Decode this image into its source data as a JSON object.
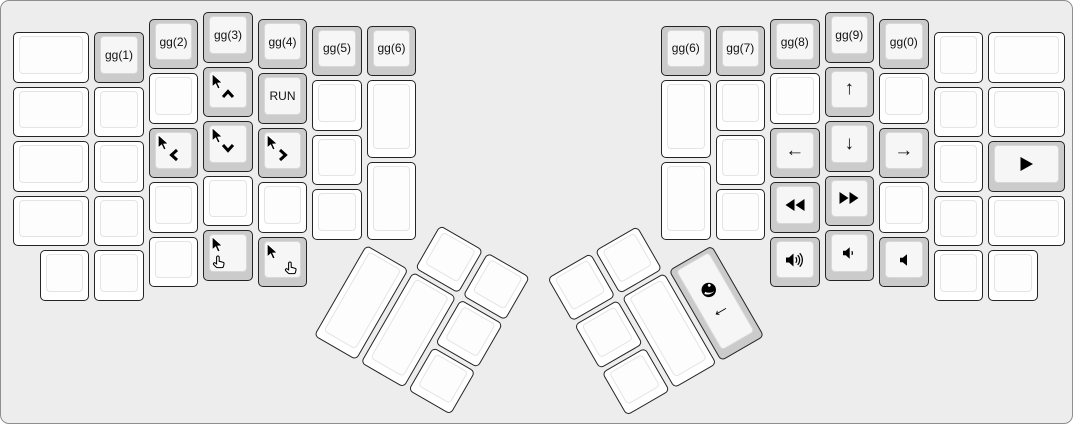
{
  "colors": {
    "canvas_bg": "#ededed",
    "key_white": "#ffffff",
    "key_gray": "#cccccc",
    "legend": "#111111",
    "key_border": "#242424"
  },
  "groups": [
    {
      "name": "left-main",
      "keys": [
        {
          "name": "key-blank",
          "x": 0,
          "y": 0.375,
          "w": 1.5,
          "color": "white"
        },
        {
          "name": "key-gg-1",
          "x": 1.5,
          "y": 0.375,
          "color": "gray",
          "label": "gg(1)"
        },
        {
          "name": "key-gg-2",
          "x": 2.5,
          "y": 0.125,
          "color": "gray",
          "label": "gg(2)"
        },
        {
          "name": "key-gg-3",
          "x": 3.5,
          "y": 0,
          "color": "gray",
          "label": "gg(3)"
        },
        {
          "name": "key-gg-4",
          "x": 4.5,
          "y": 0.125,
          "color": "gray",
          "label": "gg(4)"
        },
        {
          "name": "key-gg-5",
          "x": 5.5,
          "y": 0.25,
          "color": "gray",
          "label": "gg(5)"
        },
        {
          "name": "key-gg-6-left",
          "x": 6.5,
          "y": 0.25,
          "color": "gray",
          "label": "gg(6)"
        },
        {
          "name": "key-blank",
          "x": 0,
          "y": 1.375,
          "w": 1.5,
          "color": "white"
        },
        {
          "name": "key-blank",
          "x": 1.5,
          "y": 1.375,
          "color": "white"
        },
        {
          "name": "key-blank",
          "x": 2.5,
          "y": 1.125,
          "color": "white"
        },
        {
          "name": "key-mouse-up",
          "x": 3.5,
          "y": 1,
          "color": "gray",
          "icons": [
            {
              "icon": "mouse-cursor",
              "pos": "tl"
            },
            {
              "icon": "chevron-up",
              "pos": "c"
            }
          ]
        },
        {
          "name": "key-run",
          "x": 4.5,
          "y": 1.125,
          "color": "gray",
          "label": "RUN"
        },
        {
          "name": "key-blank",
          "x": 5.5,
          "y": 1.25,
          "color": "white"
        },
        {
          "name": "key-blank",
          "x": 6.5,
          "y": 1.25,
          "h": 1.5,
          "color": "white"
        },
        {
          "name": "key-blank",
          "x": 0,
          "y": 2.375,
          "w": 1.5,
          "color": "white"
        },
        {
          "name": "key-blank",
          "x": 1.5,
          "y": 2.375,
          "color": "white"
        },
        {
          "name": "key-mouse-left",
          "x": 2.5,
          "y": 2.125,
          "color": "gray",
          "icons": [
            {
              "icon": "mouse-cursor",
              "pos": "tl"
            },
            {
              "icon": "chevron-left",
              "pos": "c"
            }
          ]
        },
        {
          "name": "key-mouse-down",
          "x": 3.5,
          "y": 2,
          "color": "gray",
          "icons": [
            {
              "icon": "mouse-cursor",
              "pos": "tl"
            },
            {
              "icon": "chevron-down",
              "pos": "c"
            }
          ]
        },
        {
          "name": "key-mouse-right",
          "x": 4.5,
          "y": 2.125,
          "color": "gray",
          "icons": [
            {
              "icon": "mouse-cursor",
              "pos": "tl"
            },
            {
              "icon": "chevron-right",
              "pos": "c"
            }
          ]
        },
        {
          "name": "key-blank",
          "x": 5.5,
          "y": 2.25,
          "color": "white"
        },
        {
          "name": "key-blank",
          "x": 6.5,
          "y": 2.75,
          "h": 1.5,
          "color": "white"
        },
        {
          "name": "key-blank",
          "x": 0,
          "y": 3.375,
          "w": 1.5,
          "color": "white"
        },
        {
          "name": "key-blank",
          "x": 1.5,
          "y": 3.375,
          "color": "white"
        },
        {
          "name": "key-blank",
          "x": 2.5,
          "y": 3.125,
          "color": "white"
        },
        {
          "name": "key-blank",
          "x": 3.5,
          "y": 3,
          "color": "white"
        },
        {
          "name": "key-blank",
          "x": 4.5,
          "y": 3.125,
          "color": "white"
        },
        {
          "name": "key-blank",
          "x": 5.5,
          "y": 3.25,
          "color": "white"
        },
        {
          "name": "key-blank",
          "x": 0.5,
          "y": 4.375,
          "color": "white"
        },
        {
          "name": "key-blank",
          "x": 1.5,
          "y": 4.375,
          "color": "white"
        },
        {
          "name": "key-blank",
          "x": 2.5,
          "y": 4.125,
          "color": "white"
        },
        {
          "name": "key-mouse-button-1",
          "x": 3.5,
          "y": 4,
          "color": "gray",
          "icons": [
            {
              "icon": "mouse-cursor",
              "pos": "tl"
            },
            {
              "icon": "pointing-hand",
              "pos": "bl"
            }
          ]
        },
        {
          "name": "key-mouse-button-2",
          "x": 4.5,
          "y": 4.125,
          "color": "gray",
          "icons": [
            {
              "icon": "mouse-cursor",
              "pos": "tl"
            },
            {
              "icon": "pointing-hand",
              "pos": "br"
            }
          ]
        }
      ]
    },
    {
      "name": "right-main",
      "keys": [
        {
          "name": "key-gg-6-right",
          "x": 11.9,
          "y": 0.25,
          "color": "gray",
          "label": "gg(6)"
        },
        {
          "name": "key-gg-7",
          "x": 12.9,
          "y": 0.25,
          "color": "gray",
          "label": "gg(7)"
        },
        {
          "name": "key-gg-8",
          "x": 13.9,
          "y": 0.125,
          "color": "gray",
          "label": "gg(8)"
        },
        {
          "name": "key-gg-9",
          "x": 14.9,
          "y": 0,
          "color": "gray",
          "label": "gg(9)"
        },
        {
          "name": "key-gg-0",
          "x": 15.9,
          "y": 0.125,
          "color": "gray",
          "label": "gg(0)"
        },
        {
          "name": "key-blank",
          "x": 16.9,
          "y": 0.375,
          "color": "white"
        },
        {
          "name": "key-blank",
          "x": 17.9,
          "y": 0.375,
          "w": 1.5,
          "color": "white"
        },
        {
          "name": "key-blank",
          "x": 11.9,
          "y": 1.25,
          "h": 1.5,
          "color": "white"
        },
        {
          "name": "key-blank",
          "x": 12.9,
          "y": 1.25,
          "color": "white"
        },
        {
          "name": "key-blank",
          "x": 13.9,
          "y": 1.125,
          "color": "white"
        },
        {
          "name": "key-arrow-up",
          "x": 14.9,
          "y": 1,
          "color": "gray",
          "label": "↑",
          "big": true
        },
        {
          "name": "key-blank",
          "x": 15.9,
          "y": 1.125,
          "color": "white"
        },
        {
          "name": "key-blank",
          "x": 16.9,
          "y": 1.375,
          "color": "white"
        },
        {
          "name": "key-blank",
          "x": 17.9,
          "y": 1.375,
          "w": 1.5,
          "color": "white"
        },
        {
          "name": "key-blank",
          "x": 12.9,
          "y": 2.25,
          "color": "white"
        },
        {
          "name": "key-arrow-left",
          "x": 13.9,
          "y": 2.125,
          "color": "gray",
          "label": "←",
          "big": true
        },
        {
          "name": "key-arrow-down",
          "x": 14.9,
          "y": 2,
          "color": "gray",
          "label": "↓",
          "big": true
        },
        {
          "name": "key-arrow-right",
          "x": 15.9,
          "y": 2.125,
          "color": "gray",
          "label": "→",
          "big": true
        },
        {
          "name": "key-blank",
          "x": 16.9,
          "y": 2.375,
          "color": "white"
        },
        {
          "name": "key-play",
          "x": 17.9,
          "y": 2.375,
          "w": 1.5,
          "color": "gray",
          "icons": [
            {
              "icon": "play",
              "pos": "cc"
            }
          ]
        },
        {
          "name": "key-blank",
          "x": 11.9,
          "y": 2.75,
          "h": 1.5,
          "color": "white"
        },
        {
          "name": "key-blank",
          "x": 12.9,
          "y": 3.25,
          "color": "white"
        },
        {
          "name": "key-rewind",
          "x": 13.9,
          "y": 3.125,
          "color": "gray",
          "icons": [
            {
              "icon": "rewind",
              "pos": "cc"
            }
          ]
        },
        {
          "name": "key-fast-forward",
          "x": 14.9,
          "y": 3,
          "color": "gray",
          "icons": [
            {
              "icon": "fast-forward",
              "pos": "cc"
            }
          ]
        },
        {
          "name": "key-blank",
          "x": 15.9,
          "y": 3.125,
          "color": "white"
        },
        {
          "name": "key-blank",
          "x": 16.9,
          "y": 3.375,
          "color": "white"
        },
        {
          "name": "key-blank",
          "x": 17.9,
          "y": 3.375,
          "w": 1.5,
          "color": "white"
        },
        {
          "name": "key-volume-up",
          "x": 13.9,
          "y": 4.125,
          "color": "gray",
          "icons": [
            {
              "icon": "volume-up",
              "pos": "cc"
            }
          ]
        },
        {
          "name": "key-volume-down",
          "x": 14.9,
          "y": 4,
          "color": "gray",
          "icons": [
            {
              "icon": "volume-down",
              "pos": "cc"
            }
          ]
        },
        {
          "name": "key-volume-mute",
          "x": 15.9,
          "y": 4.125,
          "color": "gray",
          "icons": [
            {
              "icon": "volume-mute",
              "pos": "cc"
            }
          ]
        },
        {
          "name": "key-blank",
          "x": 16.9,
          "y": 4.375,
          "color": "white"
        },
        {
          "name": "key-blank",
          "x": 17.9,
          "y": 4.375,
          "color": "white"
        }
      ]
    },
    {
      "name": "left-thumb",
      "rotation": 30,
      "rx": 6.5,
      "ry": 4.25,
      "keys": [
        {
          "name": "key-blank",
          "x": 1,
          "y": -1,
          "color": "white"
        },
        {
          "name": "key-blank",
          "x": 2,
          "y": -1,
          "color": "white"
        },
        {
          "name": "key-blank",
          "x": 0,
          "y": 0,
          "h": 2,
          "color": "white"
        },
        {
          "name": "key-blank",
          "x": 1,
          "y": 0,
          "h": 2,
          "color": "white"
        },
        {
          "name": "key-blank",
          "x": 2,
          "y": 0,
          "color": "white"
        },
        {
          "name": "key-blank",
          "x": 2,
          "y": 1,
          "color": "white"
        }
      ]
    },
    {
      "name": "right-thumb",
      "rotation": -30,
      "rx": 12.9,
      "ry": 4.25,
      "keys": [
        {
          "name": "key-blank",
          "x": -3,
          "y": -1,
          "color": "white"
        },
        {
          "name": "key-blank",
          "x": -2,
          "y": -1,
          "color": "white"
        },
        {
          "name": "key-blank",
          "x": -3,
          "y": 0,
          "color": "white"
        },
        {
          "name": "key-blank",
          "x": -2,
          "y": 0,
          "h": 2,
          "color": "white"
        },
        {
          "name": "key-browser-back",
          "x": -1,
          "y": 0,
          "h": 2,
          "color": "gray",
          "icons": [
            {
              "icon": "globe",
              "pos": "g1"
            },
            {
              "icon": "return-arrow",
              "pos": "g2"
            }
          ]
        },
        {
          "name": "key-blank",
          "x": -3,
          "y": 1,
          "color": "white"
        }
      ]
    }
  ]
}
